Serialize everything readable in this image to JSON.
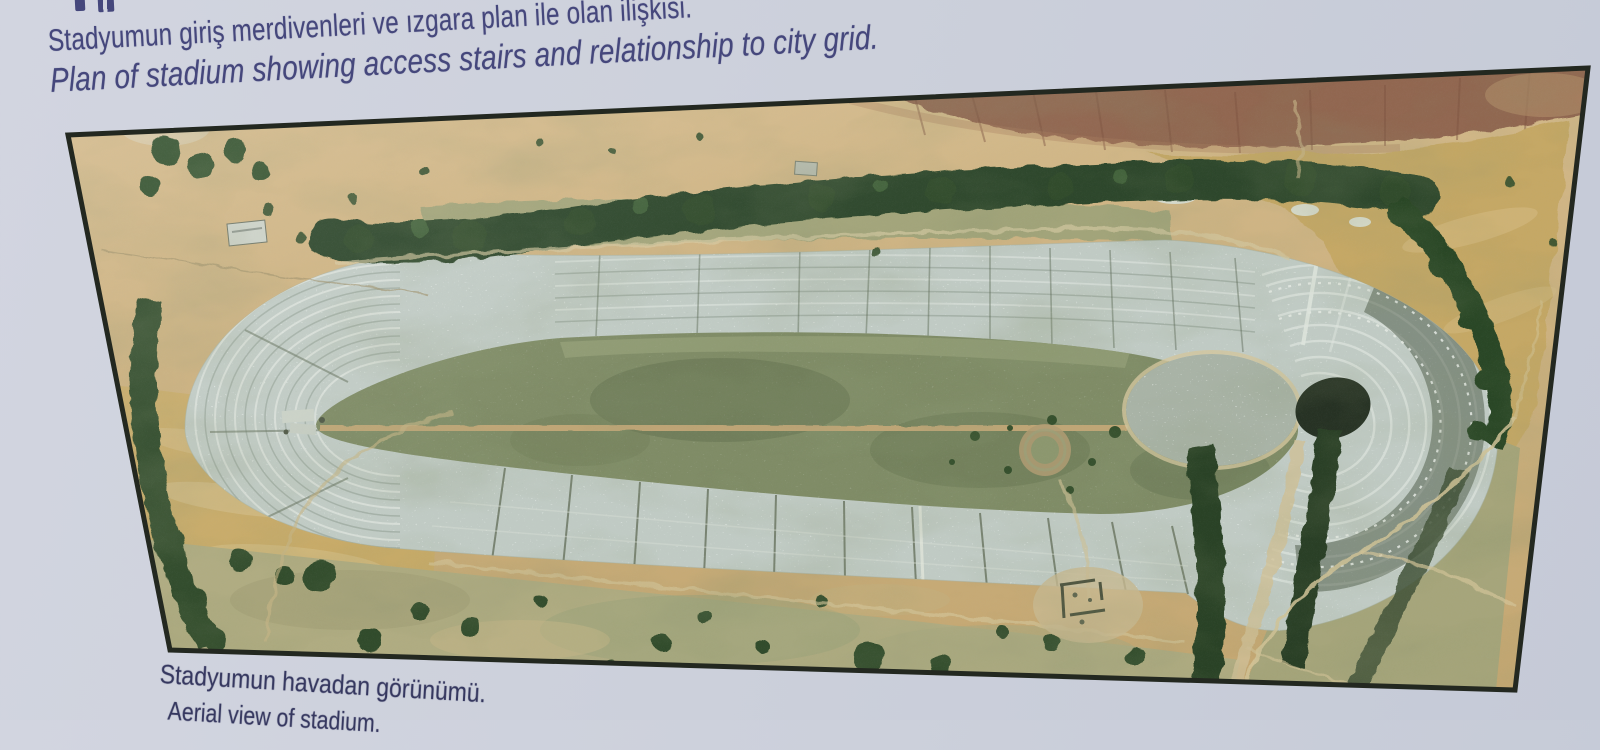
{
  "sign": {
    "heading": {
      "line_tr": "Stadyumun giriş merdivenleri ve ızgara plan ile olan ilişkisi.",
      "line_en": "Plan of stadium showing access stairs and relationship to city grid."
    },
    "caption": {
      "line_tr": "Stadyumun havadan görünümü.",
      "line_en": "Aerial view of stadium."
    },
    "photo_label": "Aerial view of the ancient stadium"
  },
  "colors": {
    "sign-bg": "#d2d5e0",
    "sign-bg-2": "#c5cad7",
    "ink": "#45477c",
    "caption-ink": "#35375f",
    "photo-border": "#232820",
    "field-tan": "#cbab74",
    "plowed-brown": "#90624a",
    "golden-field": "#c7a75f",
    "tree-green": "#2a4421",
    "stone-grey": "#c2ccc4",
    "arena-green": "#7d8960",
    "dirt-path": "#c5a773"
  }
}
